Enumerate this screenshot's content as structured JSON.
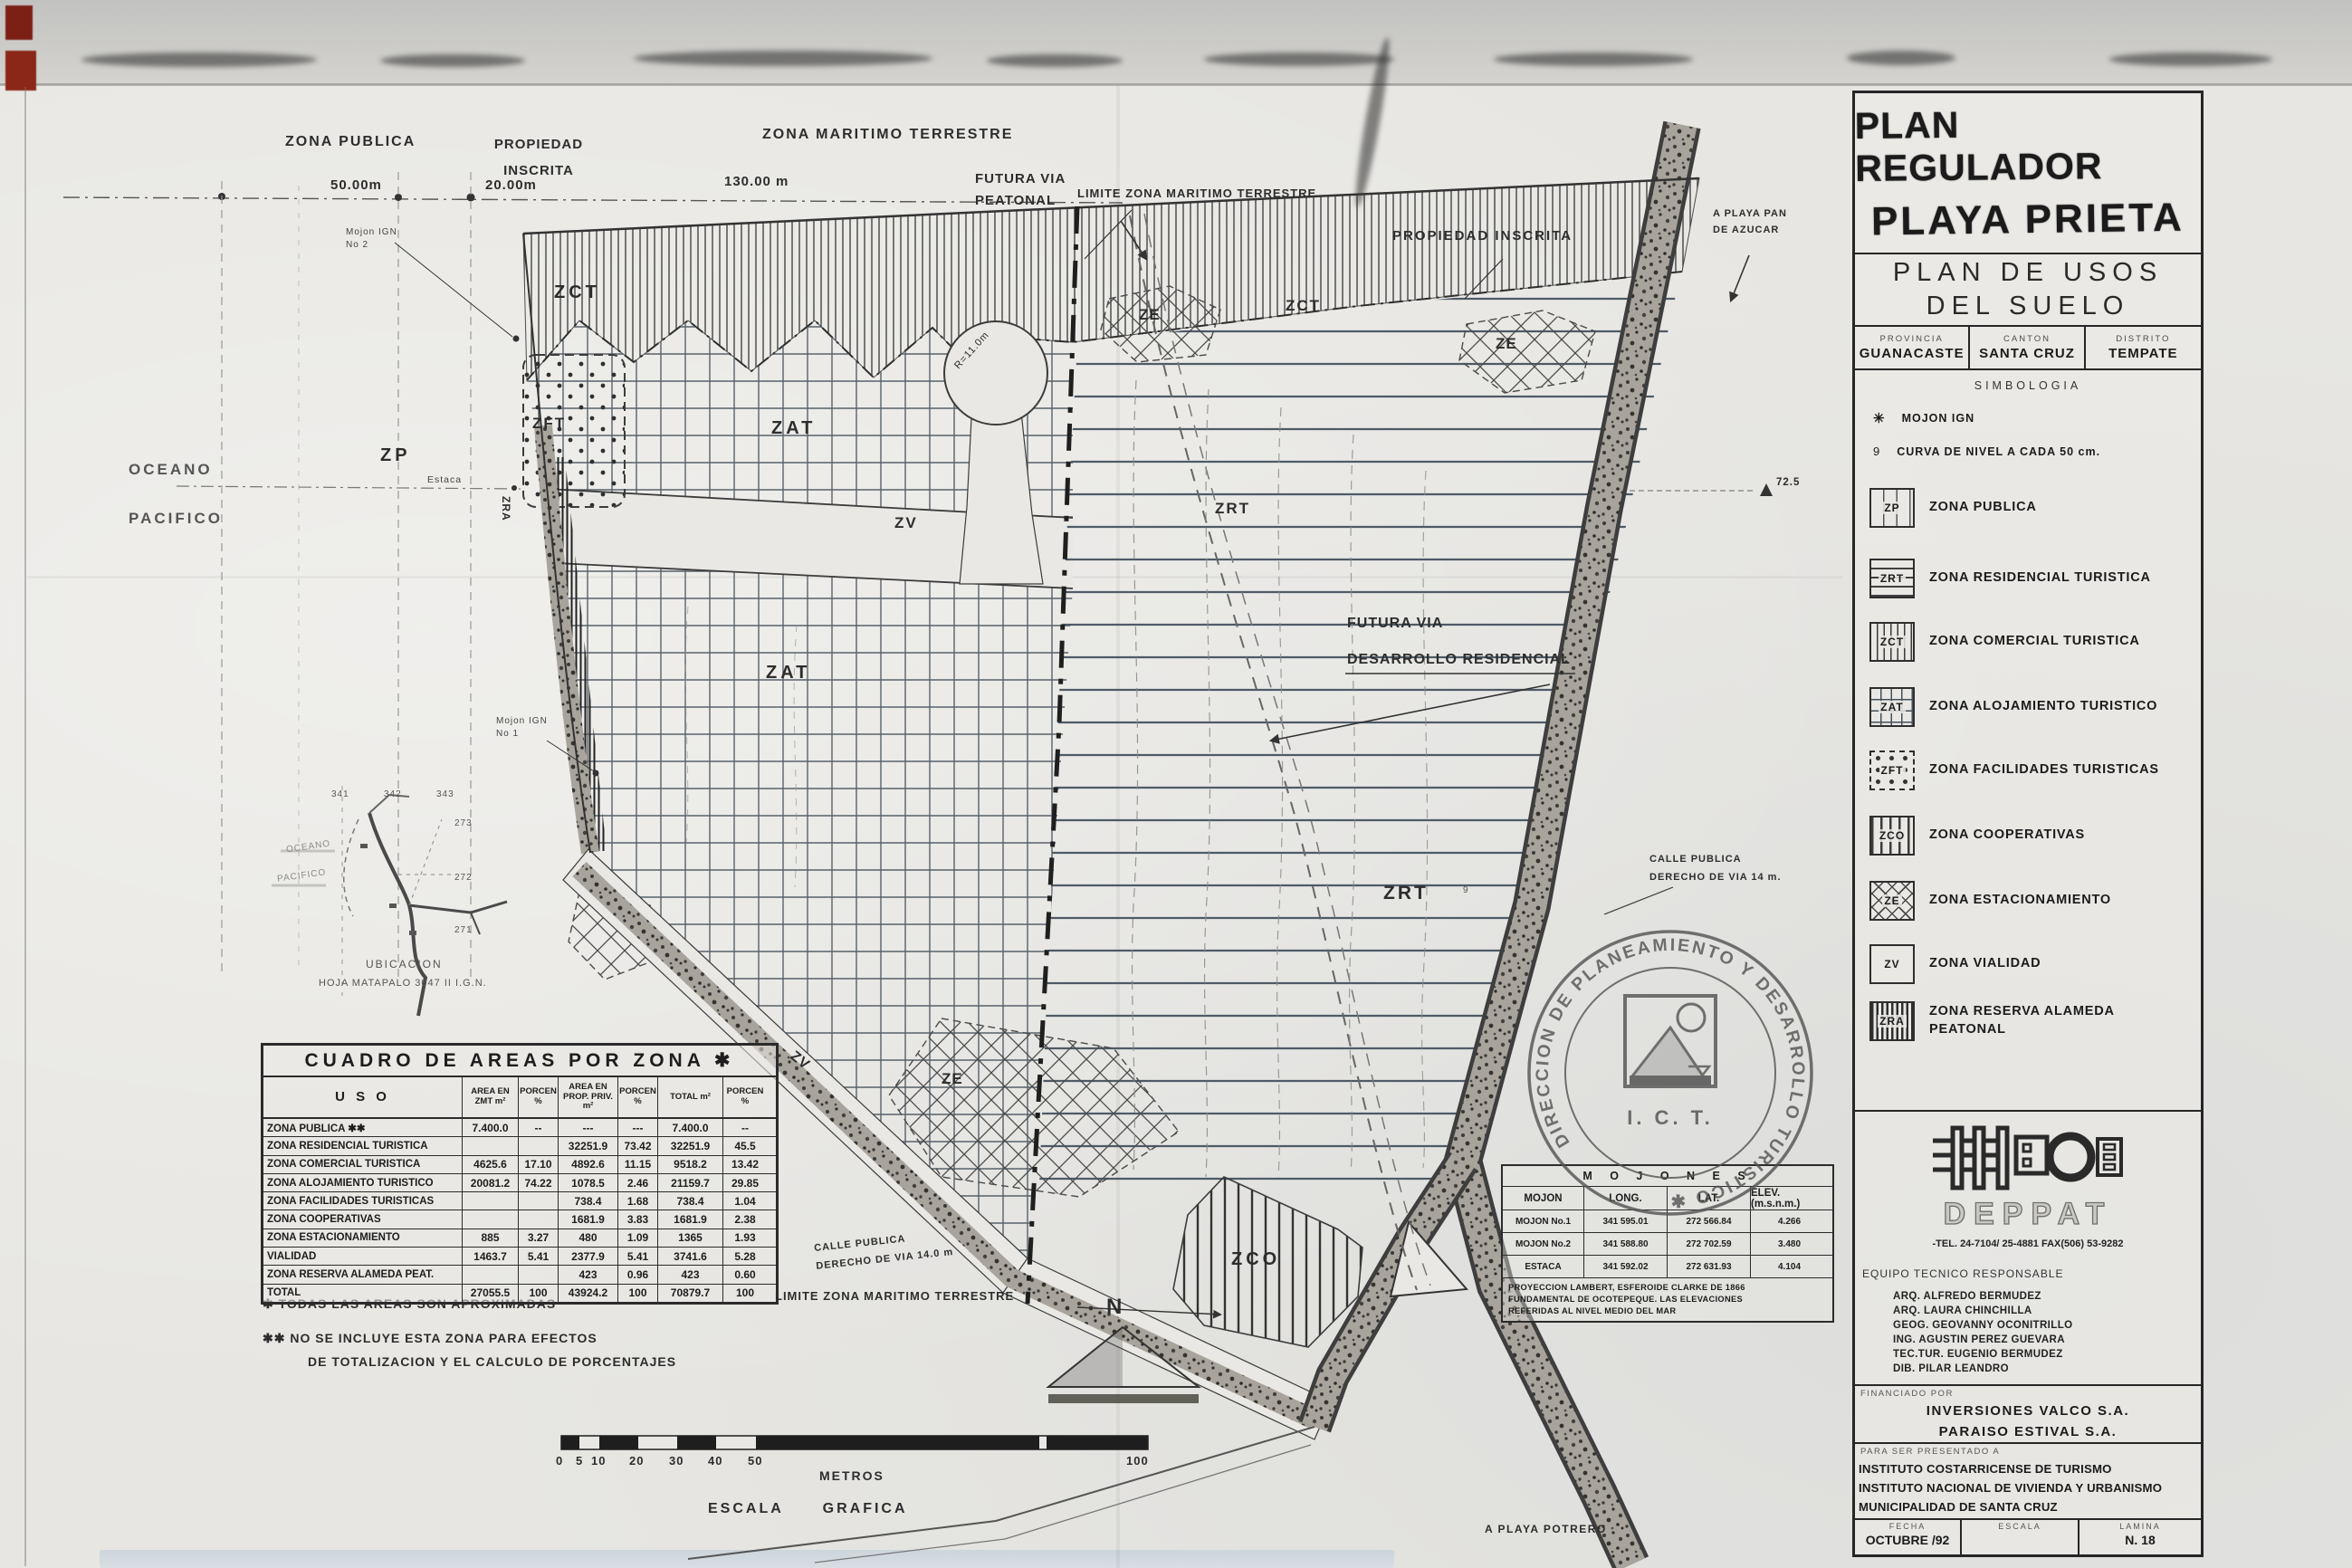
{
  "title_block": {
    "title_line1": "PLAN REGULADOR",
    "title_line2": "PLAYA PRIETA",
    "subtitle_line1": "PLAN DE USOS",
    "subtitle_line2": "DEL SUELO",
    "region": [
      {
        "label": "PROVINCIA",
        "value": "GUANACASTE"
      },
      {
        "label": "CANTON",
        "value": "SANTA CRUZ"
      },
      {
        "label": "DISTRITO",
        "value": "TEMPATE"
      }
    ]
  },
  "legend": {
    "heading": "SIMBOLOGIA",
    "symbols": [
      {
        "icon": "✳",
        "label": "MOJON IGN"
      },
      {
        "icon": "9",
        "label": "CURVA DE NIVEL A CADA 50 cm."
      }
    ],
    "zones": [
      {
        "code": "ZP",
        "label": "ZONA PUBLICA"
      },
      {
        "code": "ZRT",
        "label": "ZONA RESIDENCIAL TURISTICA"
      },
      {
        "code": "ZCT",
        "label": "ZONA COMERCIAL TURISTICA"
      },
      {
        "code": "ZAT",
        "label": "ZONA ALOJAMIENTO TURISTICO"
      },
      {
        "code": "ZFT",
        "label": "ZONA FACILIDADES TURISTICAS"
      },
      {
        "code": "ZCO",
        "label": "ZONA COOPERATIVAS"
      },
      {
        "code": "ZE",
        "label": "ZONA ESTACIONAMIENTO"
      },
      {
        "code": "ZV",
        "label": "ZONA VIALIDAD"
      },
      {
        "code": "ZRA",
        "label": "ZONA RESERVA ALAMEDA PEATONAL"
      }
    ]
  },
  "firm": {
    "name": "DEPPAT",
    "tel_line": "-TEL. 24-7104/ 25-4881  FAX(506) 53-9282",
    "team_heading": "EQUIPO TECNICO RESPONSABLE",
    "team": [
      "ARQ. ALFREDO BERMUDEZ",
      "ARQ. LAURA CHINCHILLA",
      "GEOG. GEOVANNY OCONITRILLO",
      "ING. AGUSTIN PEREZ GUEVARA",
      "TEC.TUR. EUGENIO BERMUDEZ",
      "DIB. PILAR LEANDRO"
    ]
  },
  "financed": {
    "heading": "FINANCIADO POR",
    "names": [
      "INVERSIONES  VALCO  S.A.",
      "PARAISO  ESTIVAL  S.A."
    ]
  },
  "presented": {
    "heading": "PARA SER PRESENTADO A",
    "names": [
      "INSTITUTO  COSTARRICENSE  DE  TURISMO",
      "INSTITUTO  NACIONAL  DE  VIVIENDA  Y  URBANISMO",
      "MUNICIPALIDAD  DE  SANTA  CRUZ"
    ]
  },
  "footer": {
    "fecha_label": "FECHA",
    "fecha": "OCTUBRE /92",
    "escala_label": "ESCALA",
    "escala": "",
    "lamina_label": "LAMINA",
    "lamina": "N. 18"
  },
  "areas_table": {
    "title": "CUADRO  DE  AREAS  POR  ZONA  ✱",
    "headers": [
      "U S O",
      "AREA EN ZMT m²",
      "PORCEN %",
      "AREA EN PROP. PRIV. m²",
      "PORCEN %",
      "TOTAL m²",
      "PORCEN %"
    ],
    "rows": [
      [
        "ZONA PUBLICA ✱✱",
        "7.400.0",
        "--",
        "---",
        "---",
        "7.400.0",
        "--"
      ],
      [
        "ZONA RESIDENCIAL TURISTICA",
        "",
        "",
        "32251.9",
        "73.42",
        "32251.9",
        "45.5"
      ],
      [
        "ZONA COMERCIAL TURISTICA",
        "4625.6",
        "17.10",
        "4892.6",
        "11.15",
        "9518.2",
        "13.42"
      ],
      [
        "ZONA ALOJAMIENTO TURISTICO",
        "20081.2",
        "74.22",
        "1078.5",
        "2.46",
        "21159.7",
        "29.85"
      ],
      [
        "ZONA FACILIDADES TURISTICAS",
        "",
        "",
        "738.4",
        "1.68",
        "738.4",
        "1.04"
      ],
      [
        "ZONA COOPERATIVAS",
        "",
        "",
        "1681.9",
        "3.83",
        "1681.9",
        "2.38"
      ],
      [
        "ZONA ESTACIONAMIENTO",
        "885",
        "3.27",
        "480",
        "1.09",
        "1365",
        "1.93"
      ],
      [
        "VIALIDAD",
        "1463.7",
        "5.41",
        "2377.9",
        "5.41",
        "3741.6",
        "5.28"
      ],
      [
        "ZONA RESERVA ALAMEDA PEAT.",
        "",
        "",
        "423",
        "0.96",
        "423",
        "0.60"
      ],
      [
        "TOTAL",
        "27055.5",
        "100",
        "43924.2",
        "100",
        "70879.7",
        "100"
      ]
    ]
  },
  "mojones_table": {
    "title": "M O J O N E S",
    "headers": [
      "MOJON",
      "LONG.",
      "LAT.",
      "ELEV. (m.s.n.m.)"
    ],
    "rows": [
      [
        "MOJON No.1",
        "341 595.01",
        "272 566.84",
        "4.266"
      ],
      [
        "MOJON No.2",
        "341 588.80",
        "272 702.59",
        "3.480"
      ],
      [
        "ESTACA",
        "341 592.02",
        "272 631.93",
        "4.104"
      ]
    ],
    "note_lines": [
      "PROYECCION LAMBERT, ESFEROIDE CLARKE DE 1866",
      "FUNDAMENTAL DE OCOTEPEQUE. LAS ELEVACIONES",
      "REFERIDAS AL NIVEL MEDIO DEL MAR"
    ]
  },
  "stamp": {
    "ring_text": "DIRECCION DE PLANEAMIENTO Y DESARROLLO TURISTICO ✱",
    "center_text": "I. C. T."
  },
  "notes": {
    "note1": "✱ TODAS LAS AREAS SON APROXIMADAS",
    "note2_l1": "✱✱ NO SE INCLUYE ESTA ZONA PARA EFECTOS",
    "note2_l2": "DE TOTALIZACION Y EL CALCULO DE PORCENTAJES"
  },
  "scalebar": {
    "ticks": [
      "0",
      "5",
      "10",
      "20",
      "30",
      "40",
      "50",
      "100"
    ],
    "unit": "METROS",
    "caption": "ESCALA GRAFICA"
  },
  "north": {
    "letter": "N"
  },
  "inset": {
    "caption_line1": "UBICACION",
    "caption_line2": "HOJA MATAPALO 3047 II  I.G.N.",
    "grid_x": [
      "341",
      "342",
      "343"
    ],
    "grid_y": [
      "273",
      "272",
      "271"
    ],
    "ocean_l1": "OCEANO",
    "ocean_l2": "PACIFICO"
  },
  "map": {
    "zona_publica": "ZONA PUBLICA",
    "propiedad_inscrita_l1": "PROPIEDAD",
    "propiedad_inscrita_l2": "INSCRITA",
    "zona_maritimo": "ZONA MARITIMO TERRESTRE",
    "futura_peatonal_l1": "FUTURA VIA",
    "futura_peatonal_l2": "PEATONAL",
    "limite_top": "LIMITE ZONA MARITIMO TERRESTRE",
    "propiedad_inscrita_r": "PROPIEDAD INSCRITA",
    "playa_pan_l1": "A PLAYA PAN",
    "playa_pan_l2": "DE AZUCAR",
    "dim_50": "50.00m",
    "dim_20": "20.00m",
    "dim_130": "130.00 m",
    "mojon2_l1": "Mojon IGN",
    "mojon2_l2": "No 2",
    "mojon1_l1": "Mojon IGN",
    "mojon1_l2": "No 1",
    "oceano_l1": "OCEANO",
    "oceano_l2": "PACIFICO",
    "zp": "ZP",
    "estaca": "Estaca",
    "elev": "72.5",
    "contour_mark": "9",
    "zct_a": "ZCT",
    "zct_b": "ZCT",
    "ze_a": "ZE",
    "ze_b": "ZE",
    "ze_c": "ZE",
    "zv_a": "ZV",
    "zv_b": "ZV",
    "zat_a": "ZAT",
    "zat_b": "ZAT",
    "zrt_a": "ZRT",
    "zrt_b": "ZRT",
    "zft": "ZFT",
    "zra": "ZRA",
    "zco": "ZCO",
    "r11": "R=11.0m",
    "futura_des_l1": "FUTURA VIA",
    "futura_des_l2": "DESARROLLO RESIDENCIAL",
    "calle_r_l1": "CALLE  PUBLICA",
    "calle_r_l2": "DERECHO  DE  VIA  14 m.",
    "calle_l_l1": "CALLE  PUBLICA",
    "calle_l_l2": "DERECHO  DE  VIA  14.0 m",
    "limite_bottom": "LIMITE ZONA MARITIMO TERRESTRE",
    "playa_potrero": "A PLAYA POTRERO"
  }
}
